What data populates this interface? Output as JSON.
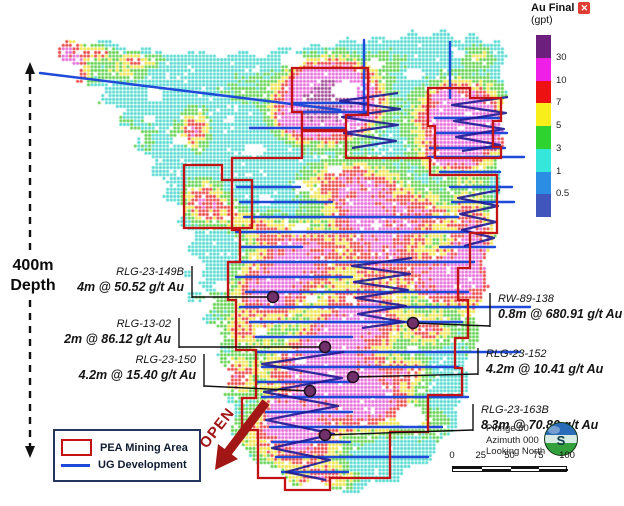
{
  "colorbar": {
    "title": "Au Final",
    "unit": "(gpt)",
    "close_icon": "x",
    "labels": [
      "30",
      "10",
      "7",
      "5",
      "3",
      "1",
      "0.5"
    ],
    "colors": [
      "#6d1f7e",
      "#ef1fe8",
      "#ee1111",
      "#f7ee1c",
      "#2fd32f",
      "#35e6da",
      "#2b8de4",
      "#4156bd"
    ]
  },
  "depth_label": {
    "line1": "400m",
    "line2": "Depth"
  },
  "open_label": "OPEN",
  "legend": {
    "items": [
      {
        "label": "PEA Mining Area",
        "swatch": "red-outline-rect"
      },
      {
        "label": "UG Development",
        "swatch": "blue-line"
      }
    ]
  },
  "orientation": {
    "plunge": "Plunge 00",
    "azimuth": "Azimuth 000",
    "looking": "Looking North"
  },
  "scalebar": {
    "ticks": [
      "0",
      "25",
      "50",
      "75",
      "100"
    ]
  },
  "annotations": [
    {
      "id": "RLG-23-149B",
      "value": "4m @ 50.52 g/t Au",
      "side": "left",
      "x": 188,
      "y": 266,
      "bracket": [
        192,
        266,
        192,
        298
      ],
      "line": [
        192,
        297,
        273,
        297
      ]
    },
    {
      "id": "RLG-13-02",
      "value": "2m @ 86.12 g/t Au",
      "side": "left",
      "x": 175,
      "y": 318,
      "bracket": [
        179,
        318,
        179,
        348
      ],
      "line": [
        179,
        347,
        325,
        347
      ]
    },
    {
      "id": "RLG-23-150",
      "value": "4.2m @ 15.40 g/t Au",
      "side": "left",
      "x": 200,
      "y": 354,
      "bracket": [
        204,
        354,
        204,
        387
      ],
      "line": [
        204,
        386,
        310,
        391
      ]
    },
    {
      "id": "RW-89-138",
      "value": "0.8m @ 680.91 g/t Au",
      "side": "right",
      "x": 494,
      "y": 293,
      "bracket": [
        490,
        293,
        490,
        327
      ],
      "line": [
        490,
        326,
        413,
        323
      ]
    },
    {
      "id": "RLG-23-152",
      "value": "4.2m @ 10.41 g/t Au",
      "side": "right",
      "x": 482,
      "y": 348,
      "bracket": [
        478,
        348,
        478,
        375
      ],
      "line": [
        478,
        374,
        353,
        377
      ]
    },
    {
      "id": "RLG-23-163B",
      "value": "8.3m @ 70.80 g/t Au",
      "side": "right",
      "x": 477,
      "y": 404,
      "bracket": [
        473,
        404,
        473,
        431
      ],
      "line": [
        473,
        430,
        325,
        435
      ]
    }
  ],
  "map": {
    "base": 1.3,
    "heat_bins": {
      "thresholds": [
        0.5,
        1,
        3,
        5,
        7,
        10,
        30
      ],
      "colors": [
        "#4a5ec4",
        "#3b93e8",
        "#4fd9cf",
        "#5ed14b",
        "#efe243",
        "#ea4040",
        "#e668d8",
        "#9c4390"
      ]
    },
    "outline": [
      [
        58,
        48
      ],
      [
        68,
        38
      ],
      [
        88,
        46
      ],
      [
        104,
        38
      ],
      [
        128,
        50
      ],
      [
        150,
        48
      ],
      [
        172,
        56
      ],
      [
        196,
        50
      ],
      [
        222,
        58
      ],
      [
        243,
        50
      ],
      [
        262,
        58
      ],
      [
        282,
        46
      ],
      [
        300,
        52
      ],
      [
        312,
        42
      ],
      [
        330,
        48
      ],
      [
        345,
        36
      ],
      [
        362,
        44
      ],
      [
        378,
        34
      ],
      [
        396,
        42
      ],
      [
        412,
        30
      ],
      [
        428,
        38
      ],
      [
        443,
        28
      ],
      [
        458,
        42
      ],
      [
        472,
        32
      ],
      [
        486,
        44
      ],
      [
        500,
        40
      ],
      [
        507,
        56
      ],
      [
        500,
        72
      ],
      [
        508,
        92
      ],
      [
        499,
        115
      ],
      [
        506,
        140
      ],
      [
        497,
        162
      ],
      [
        503,
        188
      ],
      [
        490,
        212
      ],
      [
        496,
        238
      ],
      [
        483,
        262
      ],
      [
        489,
        288
      ],
      [
        474,
        312
      ],
      [
        480,
        338
      ],
      [
        465,
        362
      ],
      [
        470,
        388
      ],
      [
        455,
        408
      ],
      [
        458,
        428
      ],
      [
        436,
        444
      ],
      [
        432,
        462
      ],
      [
        405,
        468
      ],
      [
        398,
        484
      ],
      [
        370,
        480
      ],
      [
        358,
        494
      ],
      [
        332,
        490
      ],
      [
        318,
        478
      ],
      [
        295,
        488
      ],
      [
        278,
        468
      ],
      [
        255,
        464
      ],
      [
        243,
        446
      ],
      [
        230,
        432
      ],
      [
        236,
        412
      ],
      [
        224,
        396
      ],
      [
        231,
        376
      ],
      [
        217,
        356
      ],
      [
        224,
        336
      ],
      [
        207,
        318
      ],
      [
        216,
        300
      ],
      [
        199,
        284
      ],
      [
        206,
        264
      ],
      [
        187,
        250
      ],
      [
        196,
        234
      ],
      [
        177,
        224
      ],
      [
        186,
        208
      ],
      [
        162,
        198
      ],
      [
        170,
        184
      ],
      [
        149,
        174
      ],
      [
        156,
        158
      ],
      [
        132,
        148
      ],
      [
        141,
        132
      ],
      [
        116,
        124
      ],
      [
        126,
        108
      ],
      [
        97,
        104
      ],
      [
        106,
        86
      ],
      [
        76,
        84
      ],
      [
        82,
        66
      ],
      [
        56,
        58
      ]
    ],
    "holes": [
      [
        293,
        60,
        12,
        8
      ],
      [
        345,
        90,
        13,
        9
      ],
      [
        255,
        150,
        10,
        7
      ],
      [
        300,
        230,
        8,
        6
      ],
      [
        222,
        287,
        8,
        5
      ],
      [
        336,
        170,
        8,
        5
      ],
      [
        376,
        64,
        8,
        5
      ],
      [
        415,
        74,
        10,
        6
      ],
      [
        459,
        55,
        7,
        4
      ],
      [
        155,
        95,
        9,
        7
      ],
      [
        180,
        140,
        7,
        5
      ],
      [
        230,
        120,
        6,
        4
      ],
      [
        312,
        300,
        6,
        4
      ],
      [
        302,
        360,
        6,
        4
      ],
      [
        412,
        350,
        7,
        5
      ],
      [
        410,
        417,
        14,
        12
      ],
      [
        350,
        300,
        5,
        4
      ],
      [
        262,
        330,
        5,
        4
      ],
      [
        376,
        225,
        6,
        4
      ],
      [
        300,
        186,
        7,
        5
      ],
      [
        265,
        200,
        7,
        5
      ],
      [
        150,
        120,
        6,
        4
      ]
    ],
    "islands": [
      [
        196,
        297,
        9,
        6
      ],
      [
        208,
        318,
        6,
        5
      ],
      [
        187,
        273,
        5,
        4
      ]
    ],
    "blobs": [
      [
        70,
        64,
        12,
        19,
        12
      ],
      [
        100,
        53,
        8,
        5,
        6
      ],
      [
        136,
        60,
        16,
        5,
        6
      ],
      [
        122,
        73,
        20,
        6,
        4
      ],
      [
        140,
        135,
        24,
        17,
        2
      ],
      [
        90,
        110,
        17,
        12,
        2
      ],
      [
        240,
        88,
        27,
        14,
        2
      ],
      [
        390,
        58,
        18,
        10,
        2
      ],
      [
        480,
        56,
        12,
        8,
        3.5
      ],
      [
        330,
        100,
        26,
        20,
        40
      ],
      [
        303,
        121,
        17,
        11,
        9
      ],
      [
        462,
        125,
        26,
        24,
        22
      ],
      [
        447,
        96,
        8,
        6,
        7
      ],
      [
        500,
        130,
        6,
        9,
        6
      ],
      [
        195,
        130,
        10,
        13,
        8
      ],
      [
        205,
        202,
        15,
        14,
        8.5
      ],
      [
        230,
        215,
        12,
        8,
        4
      ],
      [
        352,
        185,
        32,
        16,
        8.5
      ],
      [
        383,
        248,
        26,
        32,
        9
      ],
      [
        360,
        215,
        20,
        14,
        7
      ],
      [
        300,
        258,
        28,
        22,
        11
      ],
      [
        268,
        292,
        22,
        18,
        11
      ],
      [
        420,
        215,
        22,
        15,
        6.5
      ],
      [
        440,
        278,
        20,
        16,
        11
      ],
      [
        472,
        255,
        16,
        40,
        11
      ],
      [
        497,
        300,
        7,
        10,
        7
      ],
      [
        447,
        158,
        16,
        6,
        7
      ],
      [
        360,
        320,
        28,
        18,
        11
      ],
      [
        322,
        372,
        38,
        26,
        12
      ],
      [
        330,
        345,
        14,
        10,
        14
      ],
      [
        372,
        400,
        26,
        20,
        11
      ],
      [
        300,
        438,
        26,
        22,
        11
      ],
      [
        285,
        415,
        12,
        10,
        10
      ],
      [
        260,
        228,
        16,
        10,
        5
      ],
      [
        242,
        330,
        18,
        12,
        5
      ],
      [
        235,
        375,
        12,
        12,
        7
      ],
      [
        430,
        330,
        14,
        11,
        7
      ],
      [
        410,
        370,
        14,
        10,
        5
      ],
      [
        325,
        478,
        20,
        8,
        7
      ],
      [
        250,
        432,
        18,
        13,
        3
      ],
      [
        205,
        300,
        13,
        10,
        2.5
      ],
      [
        480,
        350,
        13,
        16,
        2.5
      ],
      [
        430,
        425,
        20,
        14,
        2.5
      ]
    ],
    "pea_polygons": [
      [
        [
          292,
          68
        ],
        [
          368,
          68
        ],
        [
          368,
          115
        ],
        [
          346,
          115
        ],
        [
          346,
          130
        ],
        [
          302,
          130
        ],
        [
          302,
          112
        ],
        [
          292,
          112
        ]
      ],
      [
        [
          428,
          88
        ],
        [
          470,
          88
        ],
        [
          470,
          98
        ],
        [
          501,
          98
        ],
        [
          501,
          121
        ],
        [
          493,
          121
        ],
        [
          493,
          147
        ],
        [
          501,
          147
        ],
        [
          501,
          158
        ],
        [
          435,
          158
        ],
        [
          435,
          126
        ],
        [
          428,
          126
        ]
      ],
      [
        [
          184,
          165
        ],
        [
          222,
          165
        ],
        [
          222,
          180
        ],
        [
          252,
          180
        ],
        [
          252,
          228
        ],
        [
          184,
          228
        ]
      ],
      [
        [
          232,
          158
        ],
        [
          302,
          158
        ],
        [
          302,
          131
        ],
        [
          346,
          131
        ],
        [
          346,
          158
        ],
        [
          430,
          158
        ],
        [
          430,
          175
        ],
        [
          497,
          175
        ],
        [
          497,
          233
        ],
        [
          470,
          233
        ],
        [
          470,
          268
        ],
        [
          458,
          268
        ],
        [
          458,
          300
        ],
        [
          468,
          300
        ],
        [
          468,
          338
        ],
        [
          455,
          338
        ],
        [
          455,
          368
        ],
        [
          462,
          368
        ],
        [
          462,
          395
        ],
        [
          428,
          395
        ],
        [
          428,
          432
        ],
        [
          390,
          432
        ],
        [
          390,
          478
        ],
        [
          330,
          478
        ],
        [
          330,
          490
        ],
        [
          285,
          490
        ],
        [
          285,
          478
        ],
        [
          258,
          478
        ],
        [
          258,
          430
        ],
        [
          242,
          430
        ],
        [
          242,
          398
        ],
        [
          256,
          398
        ],
        [
          256,
          350
        ],
        [
          236,
          350
        ],
        [
          236,
          300
        ],
        [
          228,
          300
        ],
        [
          228,
          262
        ],
        [
          240,
          262
        ],
        [
          240,
          230
        ],
        [
          232,
          230
        ]
      ]
    ],
    "ug_lines": [
      [
        40,
        73,
        340,
        110
      ],
      [
        293,
        103,
        367,
        103
      ],
      [
        293,
        112,
        367,
        112
      ],
      [
        250,
        128,
        344,
        128
      ],
      [
        435,
        118,
        499,
        118
      ],
      [
        437,
        133,
        507,
        133
      ],
      [
        430,
        148,
        505,
        148
      ],
      [
        428,
        157,
        524,
        157
      ],
      [
        440,
        172,
        500,
        172
      ],
      [
        237,
        187,
        300,
        187
      ],
      [
        450,
        187,
        512,
        187
      ],
      [
        240,
        202,
        332,
        202
      ],
      [
        452,
        202,
        514,
        202
      ],
      [
        244,
        217,
        458,
        217
      ],
      [
        236,
        232,
        470,
        232
      ],
      [
        240,
        247,
        302,
        247
      ],
      [
        440,
        247,
        495,
        247
      ],
      [
        230,
        262,
        474,
        262
      ],
      [
        236,
        277,
        352,
        277
      ],
      [
        246,
        292,
        468,
        292
      ],
      [
        240,
        307,
        530,
        307
      ],
      [
        250,
        322,
        462,
        322
      ],
      [
        256,
        337,
        352,
        337
      ],
      [
        256,
        352,
        520,
        352
      ],
      [
        262,
        367,
        458,
        367
      ],
      [
        256,
        382,
        350,
        382
      ],
      [
        262,
        397,
        468,
        397
      ],
      [
        266,
        412,
        352,
        412
      ],
      [
        270,
        427,
        442,
        427
      ],
      [
        272,
        442,
        350,
        442
      ],
      [
        276,
        457,
        428,
        457
      ],
      [
        282,
        472,
        348,
        472
      ],
      [
        364,
        40,
        364,
        112
      ],
      [
        450,
        42,
        450,
        98
      ]
    ],
    "declines": [
      [
        [
          398,
          93
        ],
        [
          340,
          101
        ],
        [
          400,
          109
        ],
        [
          342,
          117
        ],
        [
          398,
          125
        ],
        [
          344,
          133
        ],
        [
          396,
          141
        ],
        [
          352,
          148
        ]
      ],
      [
        [
          508,
          97
        ],
        [
          452,
          105
        ],
        [
          506,
          113
        ],
        [
          454,
          121
        ],
        [
          504,
          129
        ],
        [
          456,
          137
        ],
        [
          500,
          145
        ],
        [
          462,
          151
        ]
      ],
      [
        [
          412,
          258
        ],
        [
          352,
          266
        ],
        [
          410,
          274
        ],
        [
          354,
          282
        ],
        [
          408,
          290
        ],
        [
          356,
          298
        ],
        [
          406,
          306
        ],
        [
          358,
          314
        ],
        [
          404,
          322
        ],
        [
          362,
          328
        ]
      ],
      [
        [
          500,
          190
        ],
        [
          458,
          198
        ],
        [
          498,
          206
        ],
        [
          460,
          214
        ],
        [
          496,
          222
        ],
        [
          462,
          230
        ],
        [
          494,
          238
        ],
        [
          464,
          246
        ]
      ],
      [
        [
          344,
          352
        ],
        [
          262,
          364
        ],
        [
          342,
          378
        ],
        [
          264,
          392
        ],
        [
          338,
          406
        ],
        [
          266,
          420
        ],
        [
          334,
          434
        ],
        [
          272,
          448
        ],
        [
          330,
          460
        ],
        [
          286,
          472
        ],
        [
          326,
          480
        ]
      ]
    ],
    "drill_markers": [
      [
        273,
        297
      ],
      [
        325,
        347
      ],
      [
        413,
        323
      ],
      [
        310,
        391
      ],
      [
        353,
        377
      ],
      [
        325,
        435
      ]
    ]
  }
}
